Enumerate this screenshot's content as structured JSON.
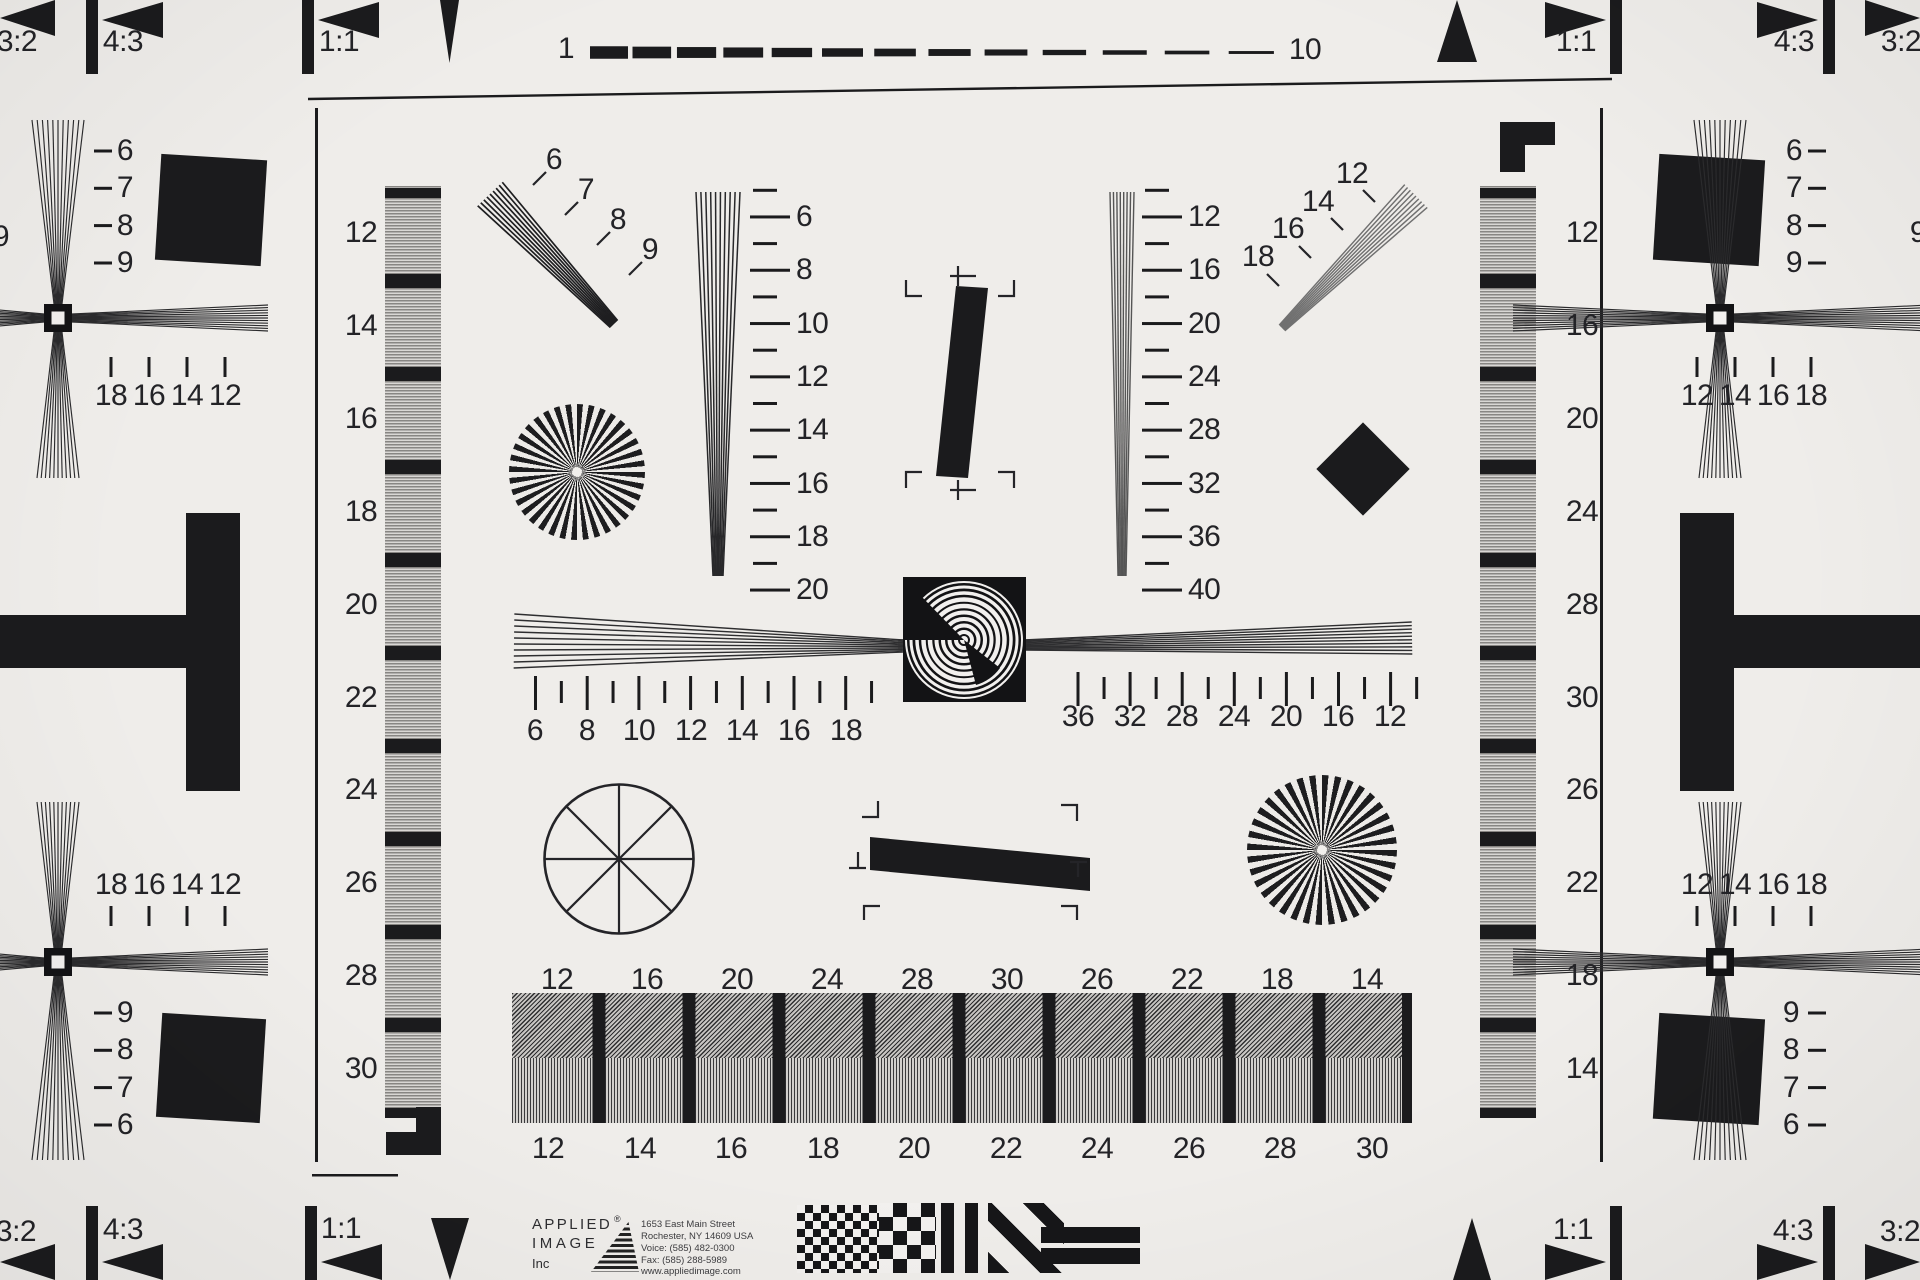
{
  "edges": {
    "top_left": [
      "3:2",
      "4:3",
      "1:1"
    ],
    "top_right": [
      "1:1",
      "4:3",
      "3:2"
    ],
    "bottom_left": [
      "3:2",
      "4:3",
      "1:1"
    ],
    "bottom_right": [
      "1:1",
      "4:3",
      "3:2"
    ],
    "scale_start": "1",
    "scale_end": "10"
  },
  "quadrants": {
    "top_left": {
      "wedge": [
        "6",
        "7",
        "8",
        "9"
      ],
      "ticks": [
        "18",
        "16",
        "14",
        "12"
      ]
    },
    "top_right": {
      "wedge": [
        "6",
        "7",
        "8",
        "9"
      ],
      "ticks": [
        "12",
        "14",
        "16",
        "18"
      ]
    },
    "bottom_left": {
      "wedge": [
        "9",
        "8",
        "7",
        "6"
      ],
      "ticks": [
        "18",
        "16",
        "14",
        "12"
      ]
    },
    "bottom_right": {
      "wedge": [
        "9",
        "8",
        "7",
        "6"
      ],
      "ticks": [
        "12",
        "14",
        "16",
        "18"
      ]
    },
    "partial_left": "9",
    "partial_right": "9"
  },
  "left_bar": [
    "12",
    "14",
    "16",
    "18",
    "20",
    "22",
    "24",
    "26",
    "28",
    "30"
  ],
  "right_bar": [
    "12",
    "16",
    "20",
    "24",
    "28",
    "30",
    "26",
    "22",
    "18",
    "14"
  ],
  "center": {
    "diag_left": [
      "6",
      "7",
      "8",
      "9"
    ],
    "diag_right": [
      "12",
      "14",
      "16",
      "18"
    ],
    "vscale_left": [
      "6",
      "8",
      "10",
      "12",
      "14",
      "16",
      "18",
      "20"
    ],
    "vscale_right": [
      "12",
      "16",
      "20",
      "24",
      "28",
      "32",
      "36",
      "40"
    ],
    "hscale_left": [
      "6",
      "8",
      "10",
      "12",
      "14",
      "16",
      "18"
    ],
    "hscale_right": [
      "36",
      "32",
      "28",
      "24",
      "20",
      "16",
      "12"
    ]
  },
  "bottom_bar": {
    "top": [
      "12",
      "16",
      "20",
      "24",
      "28",
      "30",
      "26",
      "22",
      "18",
      "14"
    ],
    "bottom": [
      "12",
      "14",
      "16",
      "18",
      "20",
      "22",
      "24",
      "26",
      "28",
      "30"
    ]
  },
  "branding": {
    "name_line1": "APPLIED",
    "registered": "®",
    "name_line2": "IMAGE",
    "name_line3": "Inc",
    "address_line1": "1653 East Main Street",
    "address_line2": "Rochester, NY  14609  USA",
    "address_line3": "Voice:   (585) 482-0300",
    "address_line4": "Fax:      (585) 288-5989",
    "website": "www.appliedimage.com"
  },
  "colors": {
    "background": "#efedea",
    "ink": "#1b1b1d",
    "pattern_gray": "#a9a7a4"
  }
}
